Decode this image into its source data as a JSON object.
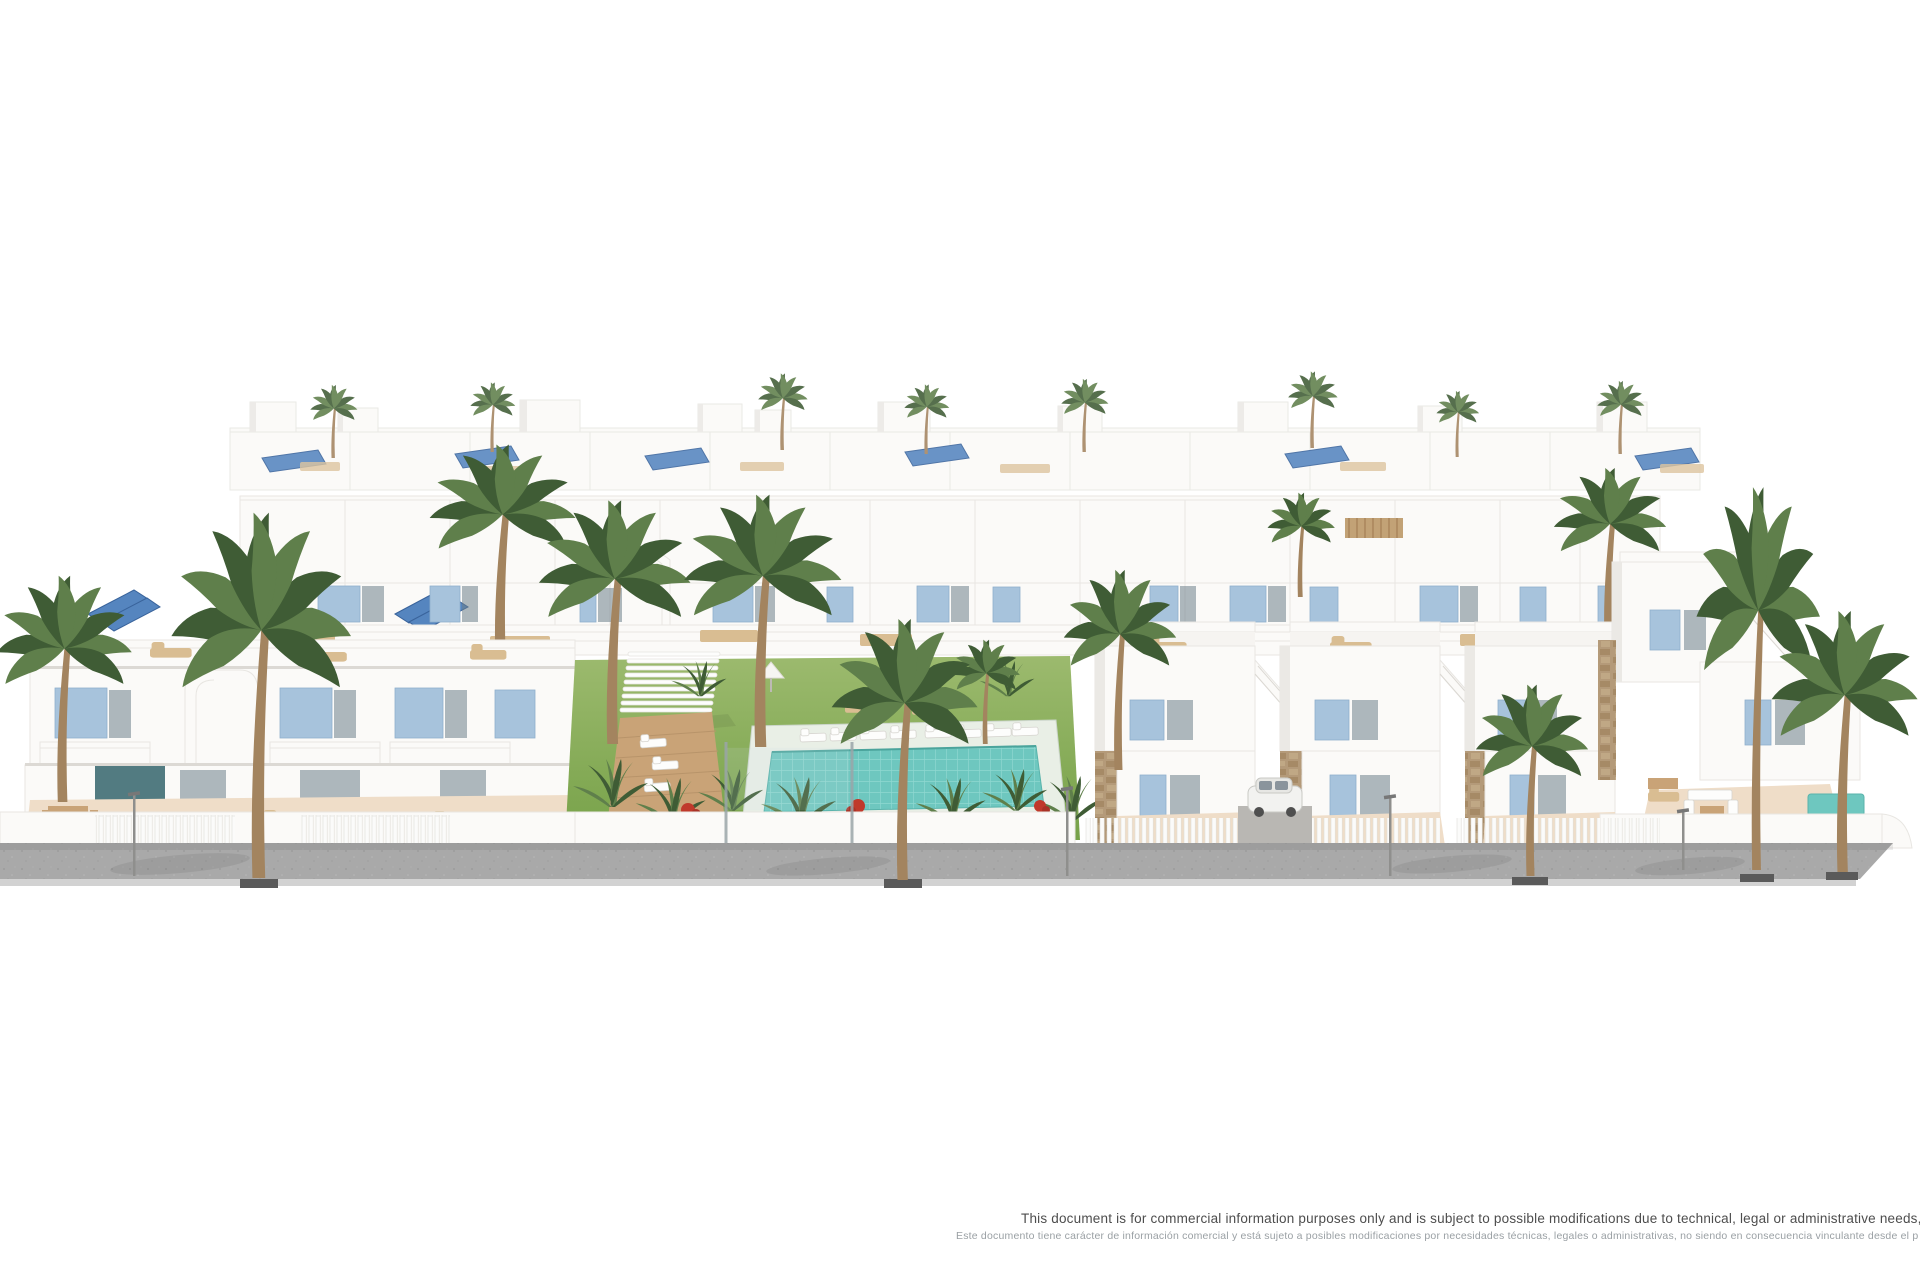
{
  "disclaimer": {
    "english": "This document is for commercial information purposes only and is subject to possible modifications due to technical, legal or administrative needs, and is therefore no",
    "spanish": "Este documento tiene carácter de información comercial y está sujeto a posibles modificaciones por necesidades técnicas, legales o administrativas, no siendo en consecuencia vinculante desde el p"
  },
  "colors": {
    "bg": "#ffffff",
    "bld_white": "#fbfaf8",
    "bld_line": "#e8e6e2",
    "bld_shadow": "#ebe9e5",
    "shutter_blue": "#a7c3dc",
    "solar_blue": "#5585bf",
    "palm_green": "#5f7f4b",
    "palm_dark": "#3f5c35",
    "trunk_brown": "#a3845f",
    "lawn_green": "#76a148",
    "pool_water": "#6ec7bf",
    "pool_deck": "#e9efe6",
    "deck_wood": "#c9a377",
    "furniture_tan": "#d9bd92",
    "terrace_beige": "#efddc8",
    "stone_tan": "#b49a79",
    "sidewalk_gray": "#a9a9a9",
    "accent_teal": "#34646c",
    "text_dark": "#4d4d4d",
    "text_light": "#9aa0a4"
  }
}
